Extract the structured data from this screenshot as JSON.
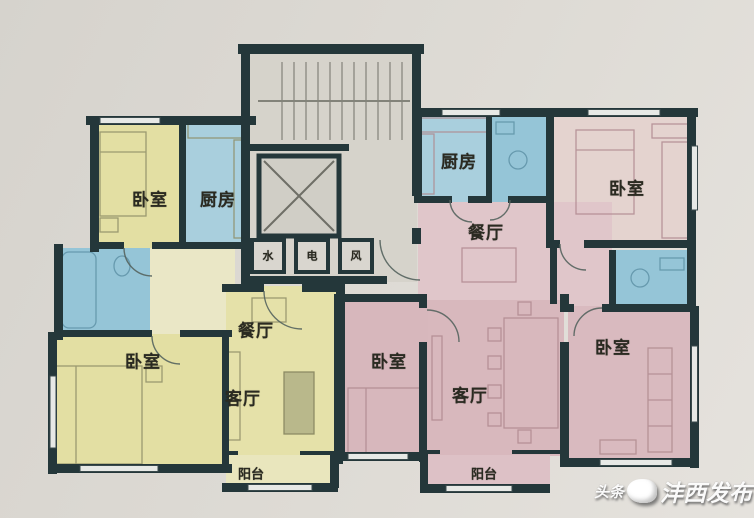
{
  "canvas": {
    "width": 754,
    "height": 518
  },
  "palette": {
    "background": "#dcd9d3",
    "wall": "#24373a",
    "left_unit_yellow": "#e3dfa3",
    "left_unit_pale": "#eae7c6",
    "right_unit_pink": "#d8b8bd",
    "right_unit_pale": "#e0c6ca",
    "wet_room_blue": "#9dc9da",
    "core_gray": "#d6d3cb",
    "label_ink": "#2a2a21"
  },
  "plan": {
    "type": "residential-floor-plan",
    "core": {
      "features": [
        "stairs",
        "elevator"
      ],
      "shafts": [
        {
          "id": "water-shaft",
          "label": "水"
        },
        {
          "id": "electric-shaft",
          "label": "电"
        },
        {
          "id": "air-shaft",
          "label": "风"
        }
      ]
    },
    "units": {
      "left": {
        "rooms": [
          {
            "id": "bedroom-top",
            "label": "卧室"
          },
          {
            "id": "kitchen",
            "label": "厨房"
          },
          {
            "id": "bedroom-bottom",
            "label": "卧室"
          },
          {
            "id": "dining",
            "label": "餐厅"
          },
          {
            "id": "living",
            "label": "客厅"
          },
          {
            "id": "balcony",
            "label": "阳台"
          }
        ]
      },
      "right": {
        "rooms": [
          {
            "id": "kitchen",
            "label": "厨房"
          },
          {
            "id": "dining",
            "label": "餐厅"
          },
          {
            "id": "bedroom-top",
            "label": "卧室"
          },
          {
            "id": "bedroom-mid",
            "label": "卧室"
          },
          {
            "id": "living",
            "label": "客厅"
          },
          {
            "id": "bedroom-bottom",
            "label": "卧室"
          },
          {
            "id": "balcony",
            "label": "阳台"
          }
        ]
      }
    }
  },
  "watermark": {
    "prefix": "头条",
    "main": "沣西发布"
  }
}
